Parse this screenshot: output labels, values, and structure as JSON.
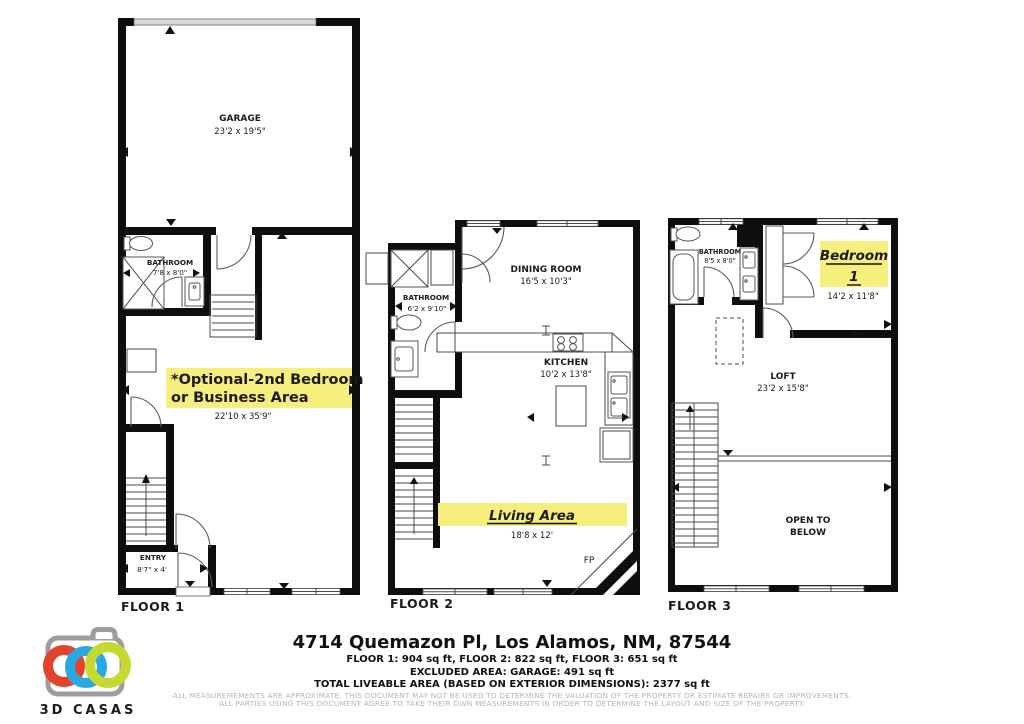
{
  "highlight_color": "#f6ef7d",
  "floor1": {
    "label": "FLOOR 1",
    "garage_name": "GARAGE",
    "garage_dims": "23'2 x 19'5\"",
    "bathroom_name": "BATHROOM",
    "bathroom_dims": "7'8 x 8'0\"",
    "optional_line1": "*Optional-2nd Bedroom",
    "optional_line2": "or  Business Area",
    "optional_dims": "22'10 x 35'9\"",
    "entry_name": "ENTRY",
    "entry_dims": "8'7\"  x 4'"
  },
  "floor2": {
    "label": "FLOOR 2",
    "dining_name": "DINING ROOM",
    "dining_dims": "16'5 x 10'3\"",
    "bathroom_name": "BATHROOM",
    "bathroom_dims": "6'2 x 9'10\"",
    "kitchen_name": "KITCHEN",
    "kitchen_dims": "10'2 x 13'8\"",
    "living_name": "Living Area",
    "living_dims": "18'8 x 12'",
    "fireplace_label": "FP"
  },
  "floor3": {
    "label": "FLOOR 3",
    "bathroom_name": "BATHROOM",
    "bathroom_dims": "8'5 x 8'0\"",
    "bedroom_line1": "Bedroom",
    "bedroom_line2": "1",
    "bedroom_dims": "14'2 x 11'8\"",
    "loft_name": "LOFT",
    "loft_dims": "23'2 x 15'8\"",
    "open_below_line1": "OPEN TO",
    "open_below_line2": "BELOW"
  },
  "footer": {
    "address": "4714 Quemazon Pl, Los Alamos, NM, 87544",
    "floor_areas": "FLOOR 1: 904 sq ft, FLOOR 2: 822 sq ft, FLOOR 3: 651 sq ft",
    "excluded_area": "EXCLUDED AREA: GARAGE: 491 sq ft",
    "total_area": "TOTAL LIVEABLE AREA (BASED ON EXTERIOR DIMENSIONS): 2377 sq ft",
    "disclaimer_line1": "ALL MEASUREMEMENTS ARE APPROXIMATE. THIS DOCUMENT MAY NOT BE USED TO DETERMINE THE VALUATION OF THE PROPERTY OR ESTIMATE REPAIRS OR IMPROVEMENTS.",
    "disclaimer_line2": "ALL PARTIES USING THIS DOCUMENT AGREE TO TAKE THEIR OWN MEASUREMENTS IN ORDER TO DETERMINE THE LAYOUT AND SIZE OF THE PROPERTY."
  },
  "logo": {
    "name": "3D CASAS",
    "camera_color": "#9d9d9d",
    "ring_red": "#e2432c",
    "ring_blue": "#29a9e1",
    "ring_green": "#c5d92f",
    "text_color": "#8f9296"
  }
}
